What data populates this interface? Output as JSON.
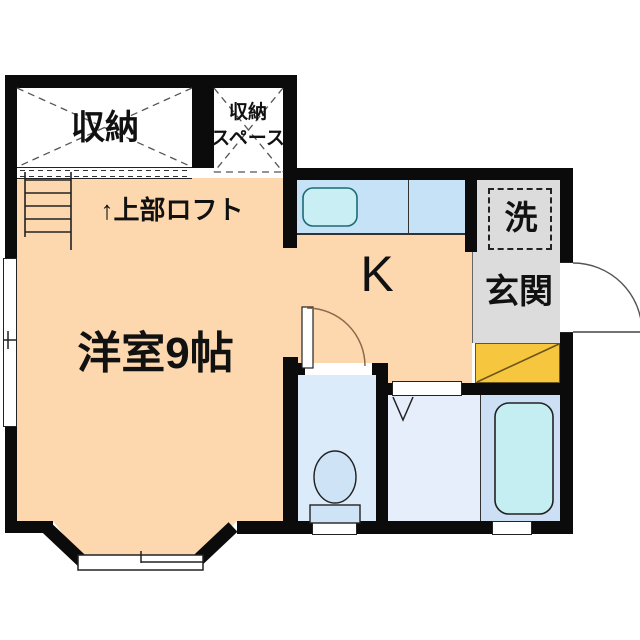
{
  "plan": {
    "type": "floor-plan",
    "labels": {
      "closet": "収納",
      "closet_space_line1": "収納",
      "closet_space_line2": "スペース",
      "loft": "↑上部ロフト",
      "western_room": "洋室9帖",
      "kitchen": "K",
      "washer": "洗",
      "entrance": "玄関"
    }
  },
  "colors": {
    "wall": "#0b0b0b",
    "floor_peach": "#fdd7ae",
    "counter": "#c5e2f6",
    "sink": "#c9eff5",
    "toilet_room": "#dcebfa",
    "washroom": "#e6eefb",
    "bath_zone": "#cddff4",
    "bathtub": "#c5eef3",
    "entrance_gray": "#dcdcdc",
    "entrance_step_yellow": "#f6c63e",
    "fixture_blue": "#cfe3f7",
    "arc_brown": "#8a6a4a",
    "line_dark": "#222222"
  }
}
